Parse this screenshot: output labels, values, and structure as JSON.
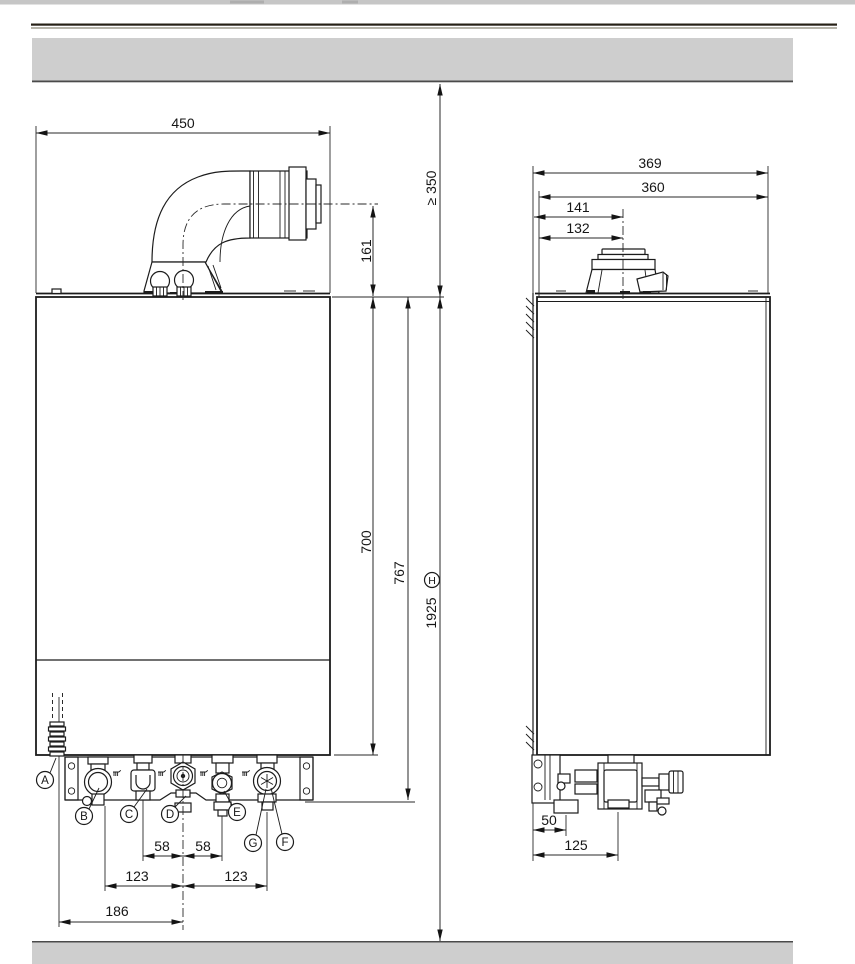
{
  "front_view": {
    "width": "450",
    "flue_height": "161",
    "clearance": "≥ 350",
    "body_height": "700",
    "conn_height": "767",
    "total_height": "1925",
    "total_ref": "H",
    "inner_left": "58",
    "inner_right": "58",
    "pitch_left": "123",
    "pitch_right": "123",
    "offset": "186",
    "labels": {
      "a": "A",
      "b": "B",
      "c": "C",
      "d": "D",
      "e": "E",
      "f": "F",
      "g": "G"
    }
  },
  "side_view": {
    "depth_total": "369",
    "depth_body": "360",
    "flue_axis_outer": "141",
    "flue_axis": "132",
    "drain_offset": "50",
    "valve_offset": "125"
  },
  "colors": {
    "band": "#cecece",
    "band_edge": "#4a4a4a",
    "line": "#1c1c1c"
  }
}
